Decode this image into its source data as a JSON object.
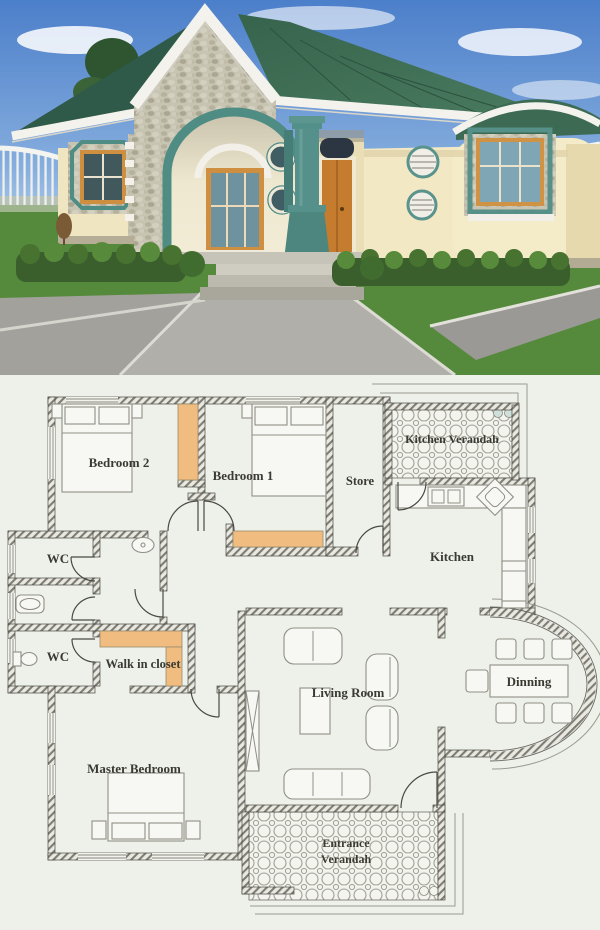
{
  "floor_plan": {
    "rooms": [
      {
        "id": "bedroom2",
        "label": "Bedroom 2"
      },
      {
        "id": "bedroom1",
        "label": "Bedroom 1"
      },
      {
        "id": "store",
        "label": "Store"
      },
      {
        "id": "kitchen_verandah",
        "label": "Kitchen Verandah"
      },
      {
        "id": "kitchen",
        "label": "Kitchen"
      },
      {
        "id": "wc_upper",
        "label": "WC"
      },
      {
        "id": "wc_lower",
        "label": "WC"
      },
      {
        "id": "walk_in_closet",
        "label": "Walk in closet"
      },
      {
        "id": "living_room",
        "label": "Living Room"
      },
      {
        "id": "dinning",
        "label": "Dinning"
      },
      {
        "id": "master_bedroom",
        "label": "Master Bedroom"
      },
      {
        "id": "entrance_verandah",
        "label_line1": "Entrance",
        "label_line2": "Verandah"
      }
    ]
  },
  "colors": {
    "sky_blue": "#4c7fca",
    "roof_green": "#3c6a53",
    "roof_green_dark": "#2f5948",
    "trim_white": "#f4f2ec",
    "wall_cream": "#f2e8c4",
    "stone_gray": "#c8c4b2",
    "teal_accent": "#4f8c84",
    "window_orange": "#cf8f41",
    "door_orange": "#c67c2e",
    "grass_green": "#558a3c",
    "hedge_green": "#3a5f2c",
    "pavement_gray": "#a6a4a0",
    "plan_background": "#eef1ea",
    "closet_orange": "#f0bc80"
  }
}
